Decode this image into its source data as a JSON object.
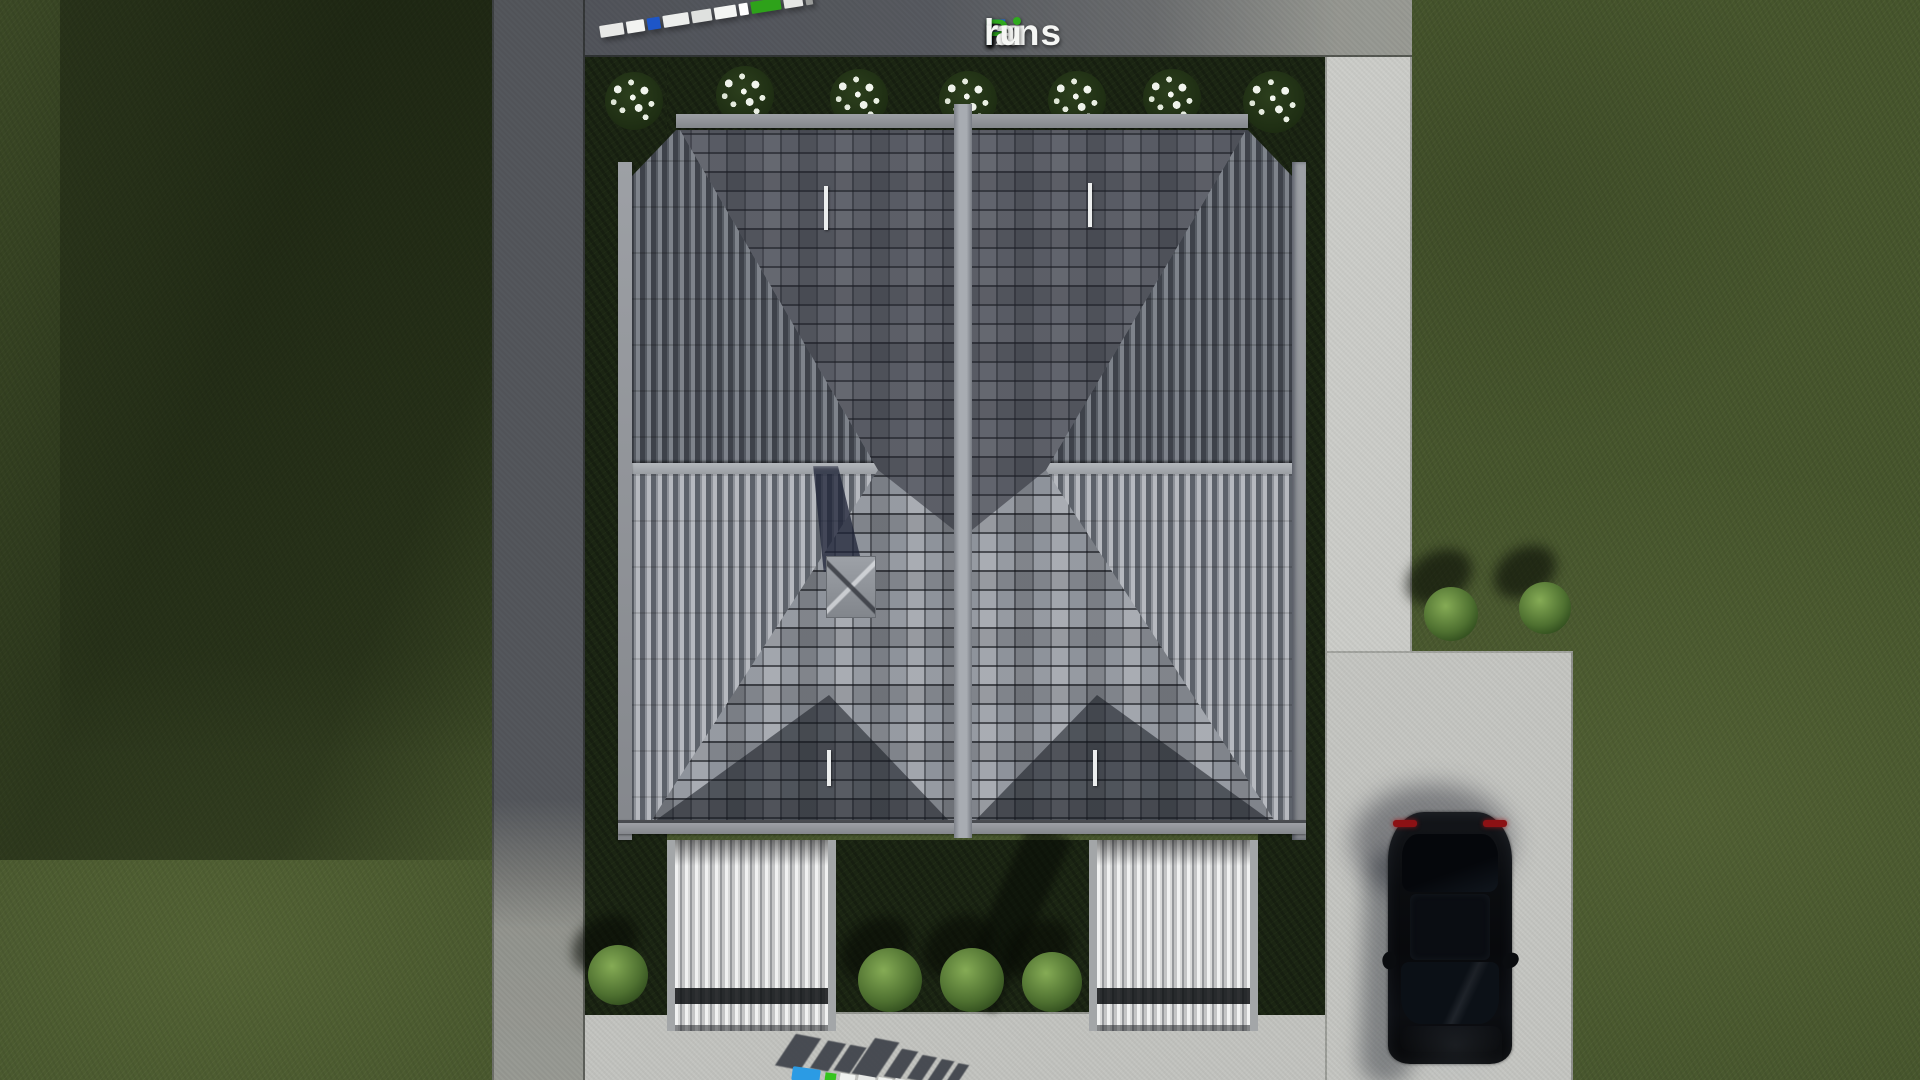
{
  "watermark": {
    "text": "FixPlans.ru",
    "parts": [
      {
        "text": "F",
        "style": "color:#1e6bd8"
      },
      {
        "text": "ix",
        "style": "color:#f5f6f4"
      },
      {
        "text": "P",
        "style": "color:#2faa1e"
      },
      {
        "text": "lans",
        "style": "color:#f5f6f4"
      },
      {
        "text": ".",
        "style": "color:#2a7de1"
      },
      {
        "text": "ru",
        "style": "color:#f5f6f4"
      }
    ]
  },
  "scene": {
    "objects": [
      "duplex-hip-roof-top-view",
      "porch-roof-left",
      "porch-roof-right",
      "chimney",
      "black-car-top-view",
      "concrete-driveway",
      "garden-paths",
      "lawn",
      "white-flowering-shrubs",
      "green-bushes",
      "fixplans-3d-sign"
    ],
    "counts": {
      "white_flowering_shrubs": 7,
      "green_bushes_bottom": 3,
      "green_bushes_right": 2,
      "green_bush_left": 1,
      "cars": 1
    },
    "colors": {
      "grass_base": "#46552c",
      "grass_shadow": "#243019",
      "grass_bed_dark": "#1b2513",
      "concrete_sunlit": "#c5c6c2",
      "concrete_shadow": "#6d7079",
      "roof_rows_base": "#8e939b",
      "roof_flank_dark": "#3e424a",
      "roof_flank_light": "#b6b9bf",
      "roof_fascia": "#8e9196",
      "wing_tile_light": "#f0f1f1",
      "wing_tile_dark": "#96989b",
      "car_body": "#0c0e11",
      "car_taillight": "#8c1114",
      "logo_blue": "#1e6bd8",
      "logo_green": "#2faa1e",
      "logo_white": "#f5f6f4"
    }
  }
}
